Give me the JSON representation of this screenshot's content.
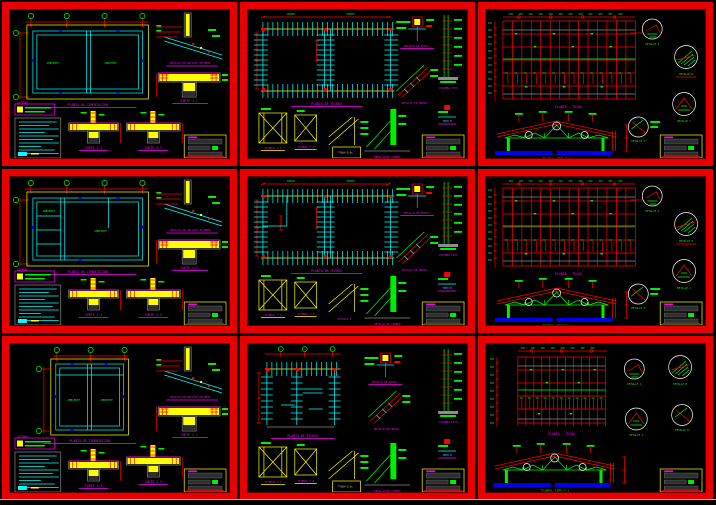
{
  "colors": {
    "background": "#000000",
    "sheet_frame_red": "#e80000",
    "wall_cyan": "#00ffff",
    "dimension_red": "#ff0000",
    "label_green": "#00ff00",
    "concrete_yellow": "#ffff00",
    "caption_magenta": "#ff00ff",
    "concrete_gray": "#8d8d8d",
    "ground_blue": "#0000ee",
    "titleblock_yellow": "#ffff00"
  },
  "board": {
    "rows": 3,
    "cols": 3
  },
  "sheets": {
    "foundation": {
      "plan_caption": "PLANTA DE CIMENTACION",
      "anchor_caption": "DETALLE DE ANCLAJE EN MURO",
      "section1_caption": "CORTE 1-1",
      "section2_caption": "CORTE 2-2",
      "section3_caption": "CORTE 3-3",
      "legend_title": "LEYENDA",
      "room_label": "AMBIENTE"
    },
    "roof_structure": {
      "plan_caption": "PLANTA DE TECHOS",
      "support_caption": "DETALLE DE APOYO",
      "column_caption": "COLUMNA TIPO",
      "union_caption": "DETALLE DE UNION",
      "panel1_caption": "TIJERAL T-1",
      "panel2_caption": "TIJERAL T-2",
      "heel_caption": "DETALLE 1",
      "member_caption": "DETALLE DE CORREA",
      "tip_caption": "TIPO H",
      "scale_caption": "ESC 1/25"
    },
    "roof_plan": {
      "plan_caption": "PLANTA - TECHO",
      "truss_caption": "TIJERAL TIPO T-1",
      "detail_a_caption": "DETALLE A",
      "detail_b_caption": "DETALLE B",
      "detail_c_caption": "DETALLE C",
      "detail_d_caption": "DETALLE D"
    }
  }
}
